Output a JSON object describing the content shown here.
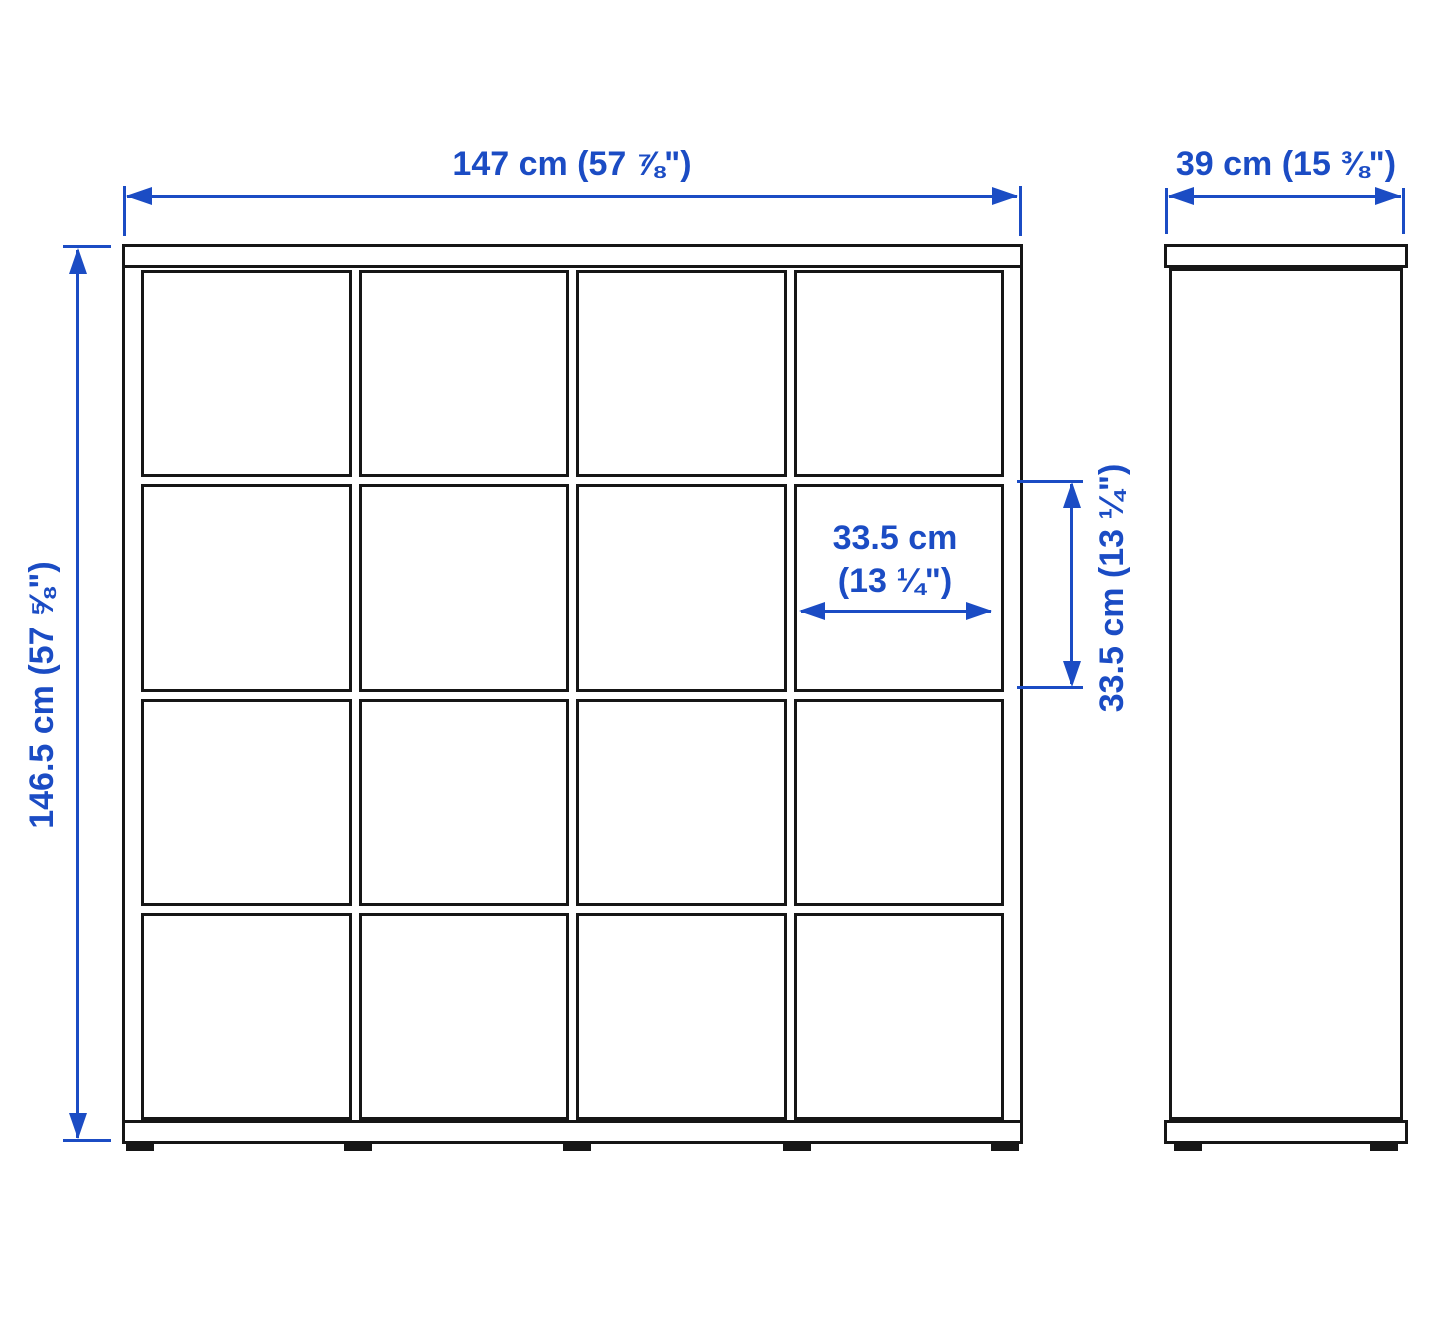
{
  "colors": {
    "dimension_blue": "#1b4cc4",
    "outline_black": "#161616",
    "background": "#ffffff"
  },
  "front_view": {
    "rows": 4,
    "columns": 4,
    "cells": 16,
    "feet": 5
  },
  "side_view": {
    "feet": 2
  },
  "dimensions": {
    "overall_width": "147 cm (57 ⅞\")",
    "overall_depth": "39 cm (15 ⅜\")",
    "overall_height": "146.5 cm (57 ⅝\")",
    "cell_width_line1": "33.5 cm",
    "cell_width_line2": "(13 ¼\")",
    "cell_height": "33.5 cm (13 ¼\")"
  }
}
